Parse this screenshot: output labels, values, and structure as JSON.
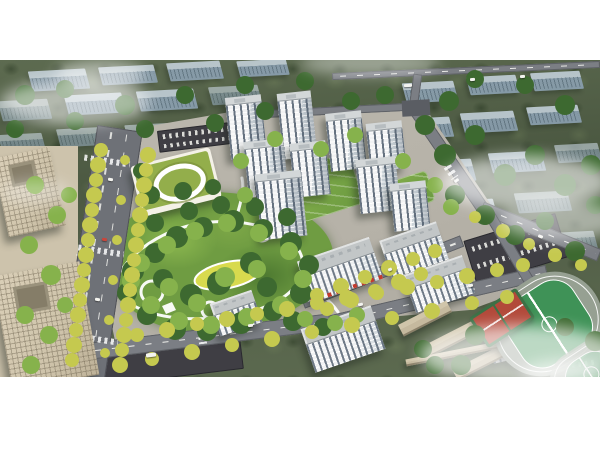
{
  "meta": {
    "description": "Aerial architectural rendering of a residential master plan: white high-rise towers around a central landscaped park, kindergarten with green roof, office towers at left, tree-lined boulevard, school campus and sports fields at lower right, faded city blocks and mist in the background",
    "type": "architectural-aerial-render"
  },
  "colors": {
    "paper": "#ffffff",
    "olive-1": "#5d6b50",
    "olive-2": "#4c5942",
    "olive-3": "#55624a",
    "bg-top": "#c5d2dc",
    "bg-face": "#8da2b4",
    "road": "#7b7e84",
    "road-mid": "#6e7177",
    "road-dark": "#3f3e44",
    "pave": "#b6b2a8",
    "plaza": "#cdc3ac",
    "park-1": "#6f9c42",
    "park-2": "#4e7a31",
    "park-3": "#8cb84f",
    "patch-yellow": "#d8da4e",
    "tree-dark": "#3d6930",
    "tree-light": "#86b24c",
    "tree-yellow": "#c5c94f",
    "tower-face": "#f1f2f3",
    "tower-shade": "#ccd4d9",
    "roof-gray": "#d3d7d8",
    "slab-roof": "#c2c6c7",
    "office": "#cfc4ab",
    "office-dark": "#857d68",
    "kwall": "#f4f1e7",
    "kroof": "#93ae4b",
    "school-tan": "#c5b99e",
    "field-green": "#3f9257",
    "track-gray": "#96a092",
    "court-red": "#b2493a",
    "court-green": "#3c7045",
    "awning": "#c23b2e",
    "mist": "#ffffff"
  },
  "labels": {
    "scene": "master-plan aerial view",
    "park": "central park with winding paths",
    "towers": "residential high-rise towers",
    "kindergarten": "kindergarten with oval green roof",
    "offices": "office towers with courtyards",
    "school": "school campus",
    "sports": "running track and football pitch",
    "courts": "basketball courts"
  }
}
